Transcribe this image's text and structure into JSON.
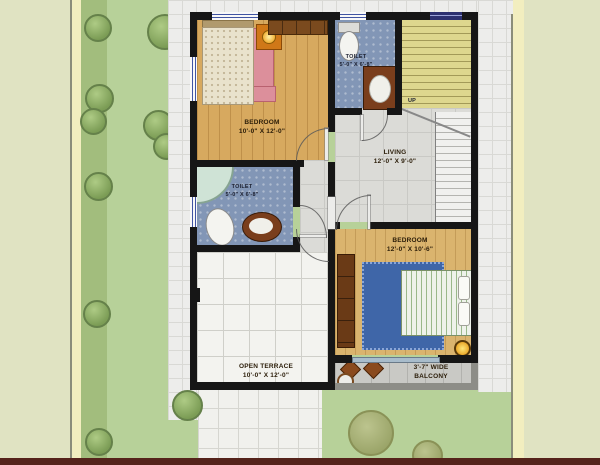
{
  "plan": {
    "rooms": {
      "bedroom1": {
        "name": "BEDROOM",
        "dims": "10'-0\" X 12'-0\""
      },
      "toilet1": {
        "name": "TOILET",
        "dims": "5'-0\" X 6'-8\""
      },
      "living": {
        "name": "LIVING",
        "dims": "12'-0\" X 9'-0\""
      },
      "toilet2": {
        "name": "TOILET",
        "dims": "5'-0\" X 6'-8\""
      },
      "bedroom2": {
        "name": "BEDROOM",
        "dims": "12'-0\" X 10'-6\""
      },
      "terrace": {
        "name": "OPEN TERRACE",
        "dims": "10'-0\" X 12'-0\""
      },
      "balcony": {
        "dims": "3'-7\" WIDE",
        "name": "BALCONY"
      }
    },
    "stairs": {
      "direction_label": "UP"
    }
  },
  "colors": {
    "wall": "#161616",
    "wood_floor": "#d7a95f",
    "wood_floor_2": "#dab46e",
    "toilet_floor_blue": "#8296b6",
    "living_tile_gray": "#dbdbd7",
    "terrace_tile_white": "#f3f3ef",
    "stair_yellow": "#ded78e",
    "pink_rug": "#dc8f9b",
    "blue_rug": "#3f66a8",
    "counter_brown": "#7a3e1c",
    "lawn_green": "#b7d199",
    "garden_green": "#a2bd7d",
    "outer_pale": "#e0e3c2",
    "boundary_cream": "#f2eebf",
    "bottom_bar_maroon": "#55231b",
    "window_blue": "#4054a2"
  }
}
